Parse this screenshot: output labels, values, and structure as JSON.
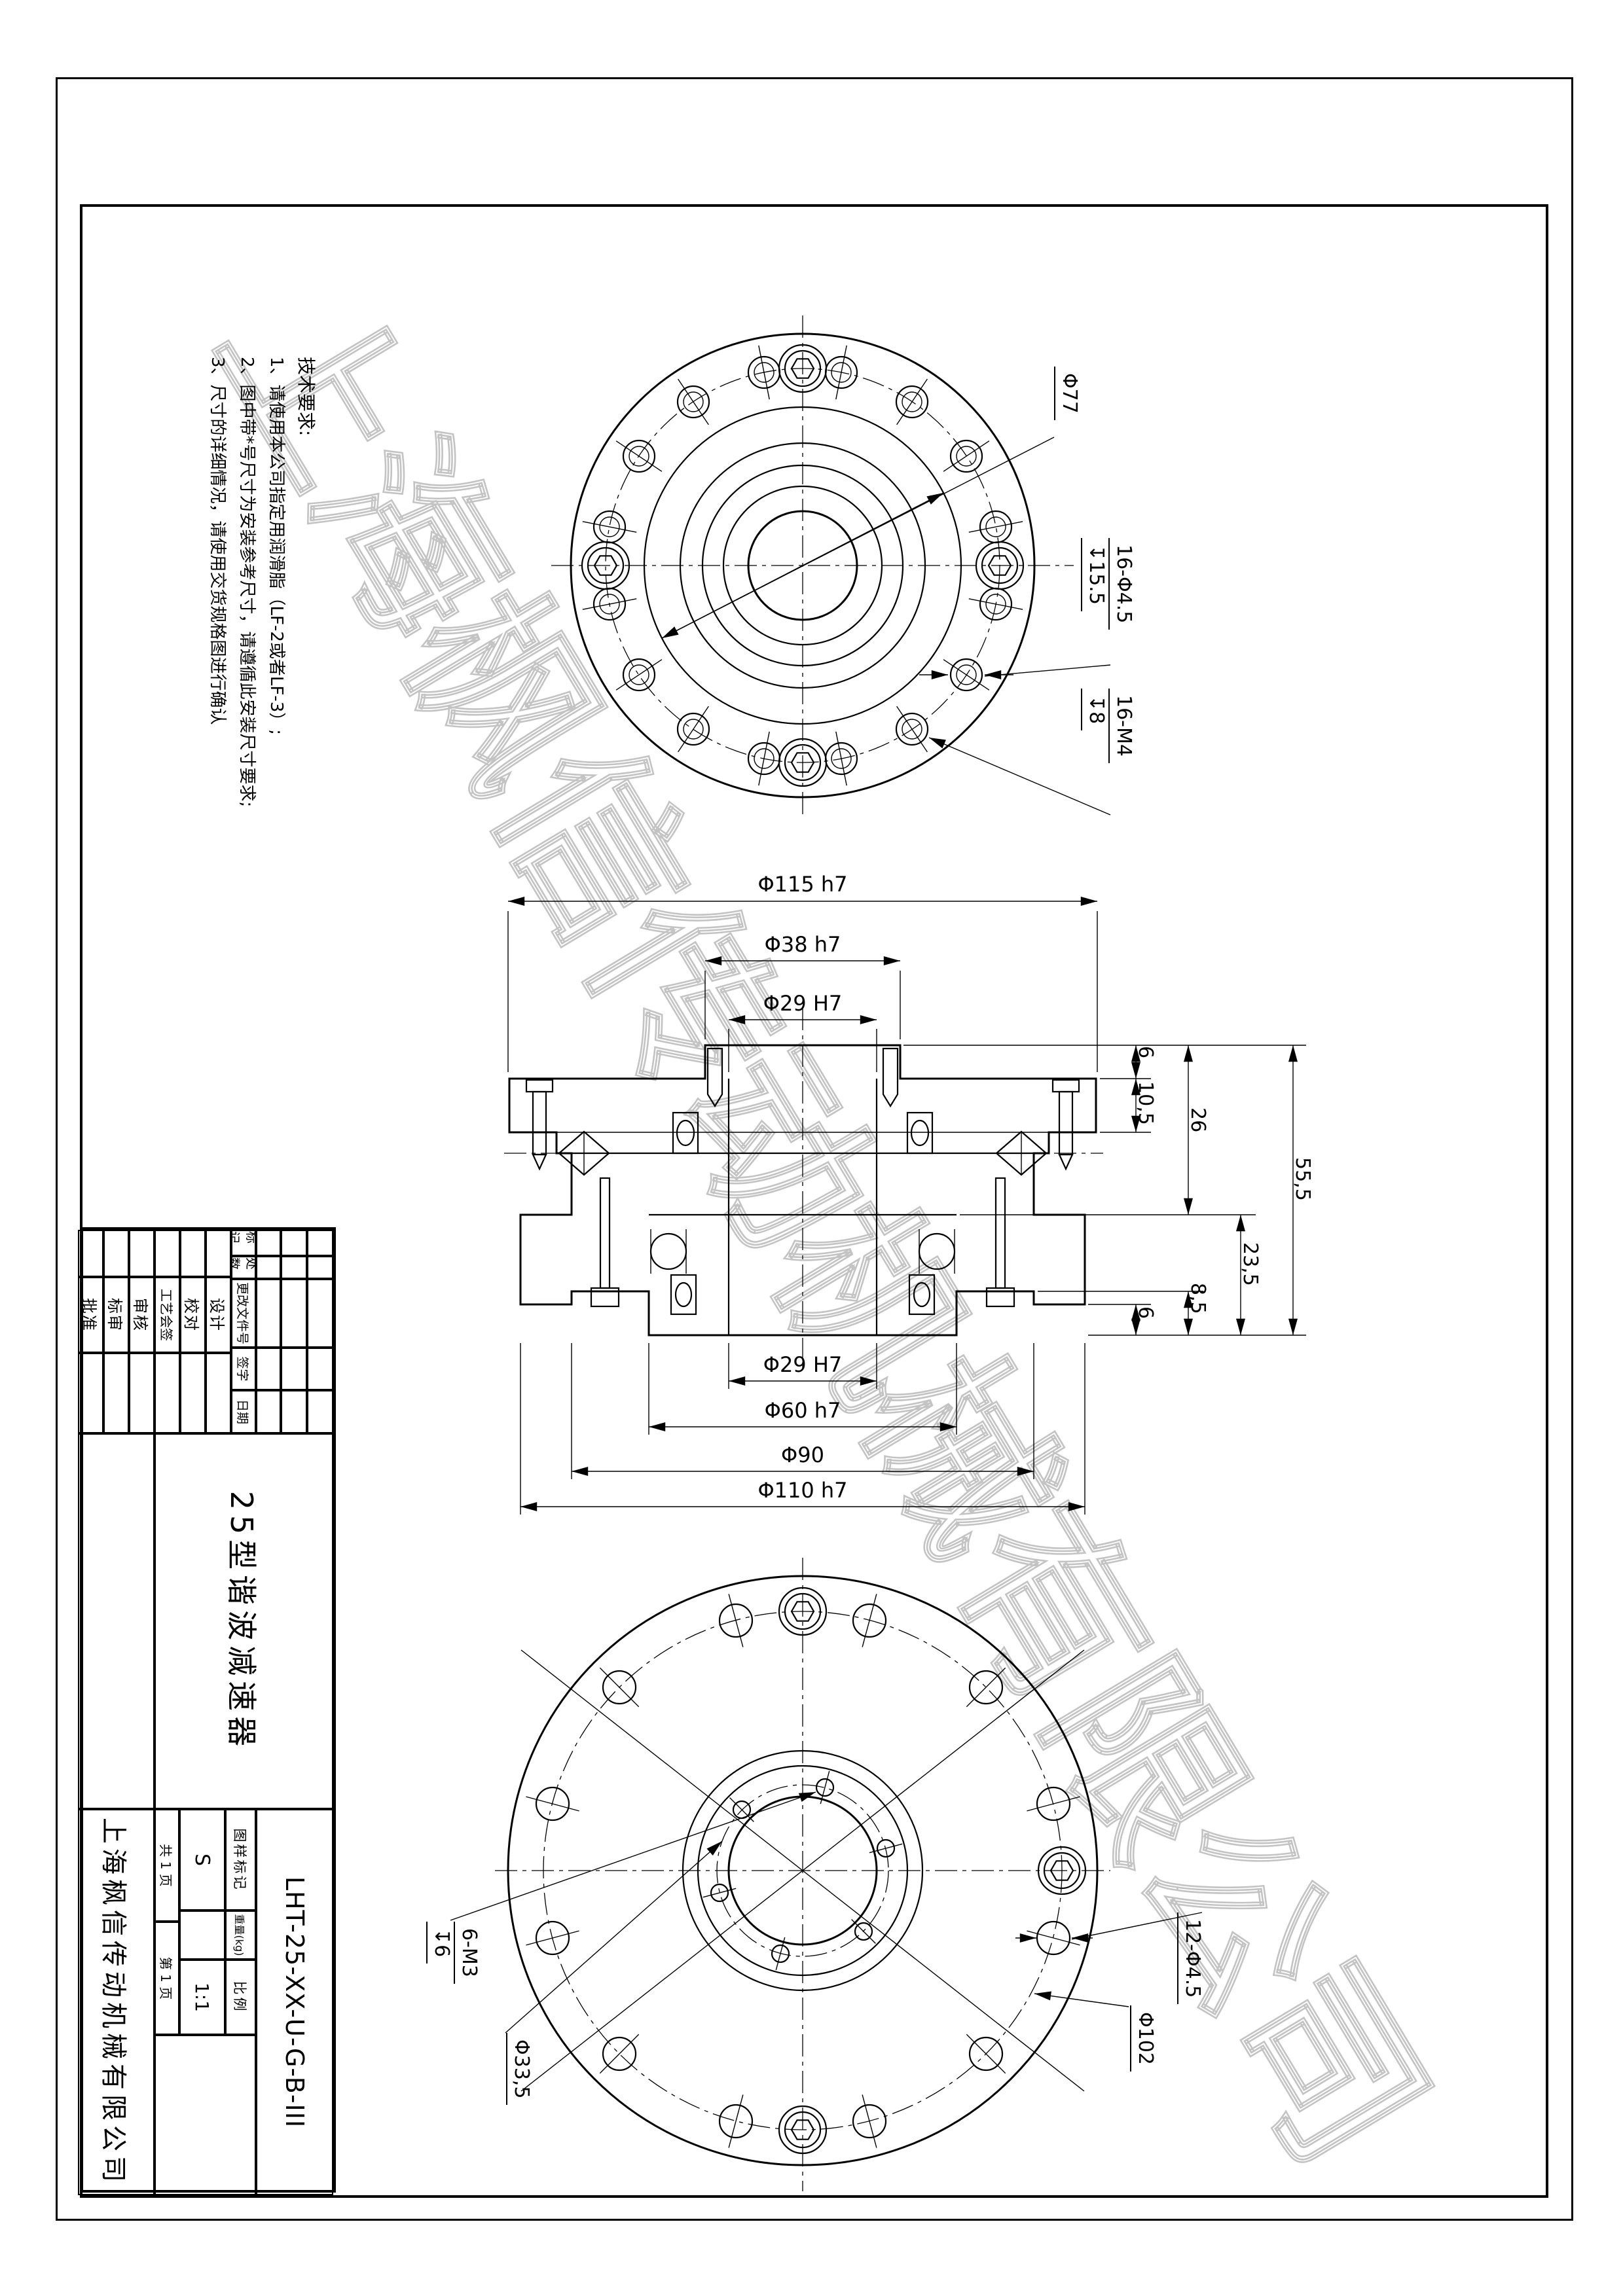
{
  "drawing": {
    "watermark": "上海枫信传动机械有限公司",
    "notes": {
      "title": "技术要求:",
      "lines": [
        "1、请使用本公司指定用润滑脂（LF-2或者LF-3）;",
        "2、图中带*号尺寸为安装参考尺寸，请遵循此安装尺寸要求;",
        "3、尺寸的详细情况，请使用交货规格图进行确认"
      ]
    },
    "top_view": {
      "dim_bolt_circle": "Φ77",
      "dim_holes": "16-Φ4.5",
      "dim_holes_depth": "↧15.5",
      "dim_taps": "16-M4",
      "dim_taps_depth": "↧8"
    },
    "section_view": {
      "dim_flange": "Φ115 h7",
      "dim_boss": "Φ38 h7",
      "dim_bore_top": "Φ29 H7",
      "dim_right": [
        "6",
        "10,5",
        "26",
        "55,5",
        "23,5",
        "8,5",
        "6"
      ],
      "dim_bore_bottom": "Φ29 H7",
      "dim_spigot": "Φ60 h7",
      "dim_body": "Φ90",
      "dim_housing": "Φ110 h7"
    },
    "bottom_view": {
      "dim_taps": "6-M3",
      "dim_taps_depth": "↧6",
      "dim_inner_circle": "Φ33,5",
      "dim_holes": "12-Φ4.5",
      "dim_bolt_circle": "Φ102"
    }
  },
  "title_block": {
    "company": "上海枫信传动机械有限公司",
    "part_name": "25型谐波减速器",
    "part_no": "LHT-25-XX-U-G-B-III",
    "rev_headers": [
      "标记",
      "处数",
      "更改文件号",
      "签字",
      "日期"
    ],
    "sig_rows": [
      "设计",
      "校对",
      "工艺会签",
      "审核",
      "标审",
      "批准"
    ],
    "stamp_label": "图样标记",
    "stamp_value": "S",
    "weight_label": "重量(kg)",
    "weight_value": "",
    "scale_label": "比例",
    "scale_value": "1:1",
    "total_pages": "共 1 页",
    "page_no": "第 1 页"
  }
}
